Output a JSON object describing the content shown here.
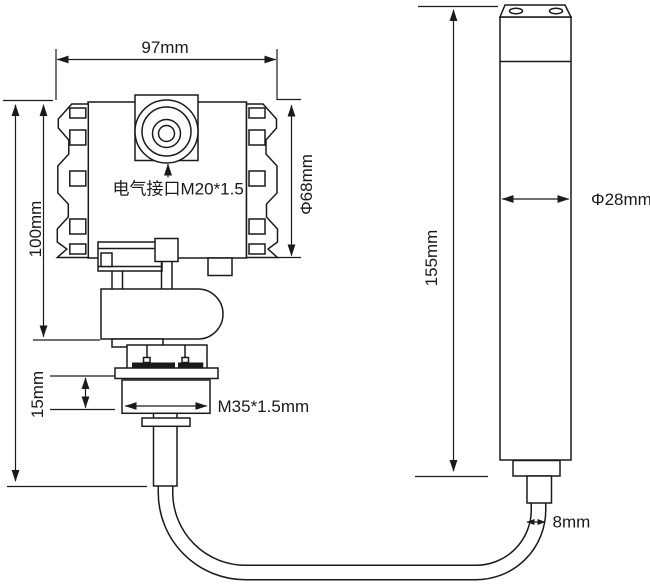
{
  "drawing": {
    "background": "#ffffff",
    "line_color": "#1a1a1a",
    "transmitter": {
      "width": "97mm",
      "height": "100mm",
      "side_cap_diameter": "Φ68mm",
      "electrical_port": "电气接口M20*1.5",
      "mount_height": "15mm",
      "thread": "M35*1.5mm"
    },
    "probe": {
      "length": "155mm",
      "diameter": "Φ28mm",
      "cable_diameter": "8mm"
    }
  }
}
